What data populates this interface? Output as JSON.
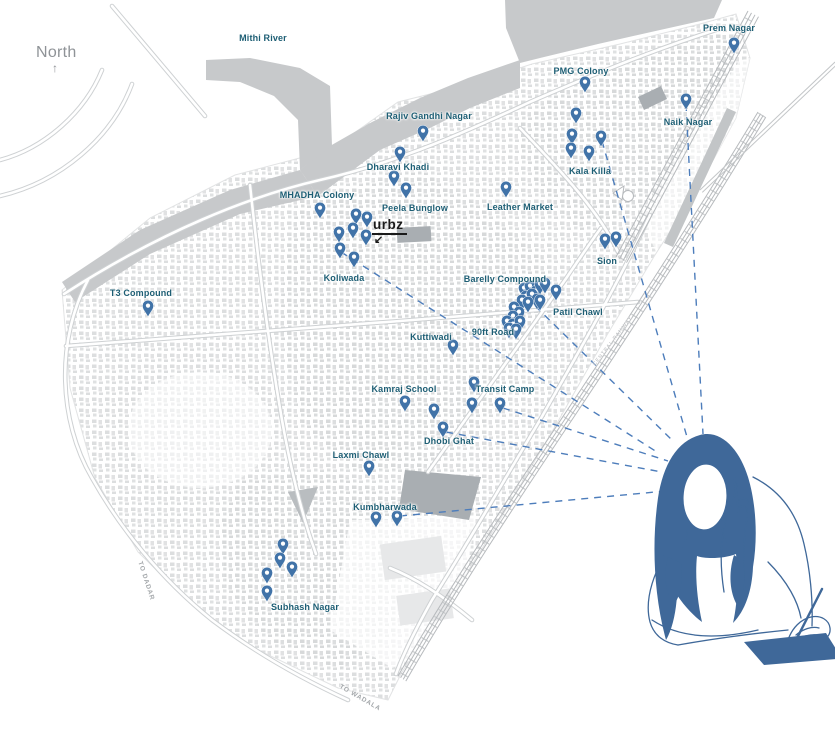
{
  "colors": {
    "pin": "#4173a8",
    "place_label": "#1d5e74",
    "road_label": "#a3a7aa",
    "rail_label": "#b0b3b6",
    "dashed_link": "#4d7dbb",
    "water": "#c7c9cb",
    "person": "#3f6899",
    "logo": "#1a1a1a",
    "north": "#8f9397"
  },
  "compass": {
    "label": "North"
  },
  "logo": {
    "text": "urbz",
    "arrow": "↙"
  },
  "map_labels": [
    {
      "id": "mithi-river",
      "text": "Mithi River",
      "x": 263,
      "y": 38,
      "type": "water"
    },
    {
      "id": "prem-nagar",
      "text": "Prem Nagar",
      "x": 729,
      "y": 28
    },
    {
      "id": "pmg-colony",
      "text": "PMG Colony",
      "x": 581,
      "y": 71
    },
    {
      "id": "naik-nagar",
      "text": "Naik Nagar",
      "x": 688,
      "y": 122
    },
    {
      "id": "kala-killa",
      "text": "Kala Killa",
      "x": 590,
      "y": 171
    },
    {
      "id": "rajiv-gandhi-nagar",
      "text": "Rajiv Gandhi Nagar",
      "x": 429,
      "y": 116
    },
    {
      "id": "dharavi-khadi",
      "text": "Dharavi Khadi",
      "x": 398,
      "y": 167
    },
    {
      "id": "mhadha-colony",
      "text": "MHADHA Colony",
      "x": 317,
      "y": 195
    },
    {
      "id": "peela-bunglow",
      "text": "Peela Bunglow",
      "x": 415,
      "y": 208
    },
    {
      "id": "leather-market",
      "text": "Leather Market",
      "x": 520,
      "y": 207
    },
    {
      "id": "koliwada",
      "text": "Koliwada",
      "x": 344,
      "y": 278
    },
    {
      "id": "barelly-compound",
      "text": "Barelly Compound",
      "x": 505,
      "y": 279
    },
    {
      "id": "patil-chawl",
      "text": "Patil Chawl",
      "x": 578,
      "y": 312
    },
    {
      "id": "sion",
      "text": "Sion",
      "x": 607,
      "y": 261
    },
    {
      "id": "t3-compound",
      "text": "T3 Compound",
      "x": 141,
      "y": 293
    },
    {
      "id": "90ft-road",
      "text": "90ft Road",
      "x": 493,
      "y": 332
    },
    {
      "id": "kuttiwadi",
      "text": "Kuttiwadi",
      "x": 431,
      "y": 337
    },
    {
      "id": "kamraj-school",
      "text": "Kamraj School",
      "x": 404,
      "y": 389
    },
    {
      "id": "transit-camp",
      "text": "Transit Camp",
      "x": 505,
      "y": 389
    },
    {
      "id": "dhobi-ghat",
      "text": "Dhobi Ghat",
      "x": 449,
      "y": 441
    },
    {
      "id": "laxmi-chawl",
      "text": "Laxmi Chawl",
      "x": 361,
      "y": 455
    },
    {
      "id": "kumbharwada",
      "text": "Kumbharwada",
      "x": 385,
      "y": 507
    },
    {
      "id": "subhash-nagar",
      "text": "Subhash Nagar",
      "x": 305,
      "y": 607
    },
    {
      "id": "to-dadar",
      "text": "TO DADAR",
      "x": 146,
      "y": 581,
      "type": "road",
      "rot": 72
    },
    {
      "id": "to-wadala",
      "text": "TO WADALA",
      "x": 360,
      "y": 698,
      "type": "road",
      "rot": 30
    },
    {
      "id": "central-railway",
      "text": "CENTRAL RAILWAY",
      "x": 613,
      "y": 341,
      "type": "rail",
      "rot": -52
    }
  ],
  "pins": [
    [
      734,
      44,
      "prem-nagar"
    ],
    [
      585,
      83,
      "pmg-colony"
    ],
    [
      686,
      100,
      "naik-nagar"
    ],
    [
      576,
      114
    ],
    [
      572,
      135
    ],
    [
      601,
      137
    ],
    [
      571,
      149
    ],
    [
      589,
      152
    ],
    [
      423,
      132,
      "rajiv-gandhi-nagar"
    ],
    [
      400,
      153
    ],
    [
      394,
      177,
      "dharavi-khadi"
    ],
    [
      406,
      189,
      "peela-bunglow"
    ],
    [
      320,
      209,
      "mhadha-colony"
    ],
    [
      506,
      188,
      "leather-market"
    ],
    [
      356,
      215
    ],
    [
      367,
      218
    ],
    [
      353,
      229
    ],
    [
      339,
      233
    ],
    [
      366,
      236
    ],
    [
      340,
      249
    ],
    [
      354,
      258
    ],
    [
      605,
      240,
      "sion"
    ],
    [
      616,
      238
    ],
    [
      148,
      307,
      "t3-compound"
    ],
    [
      524,
      289
    ],
    [
      530,
      287
    ],
    [
      536,
      292
    ],
    [
      540,
      285
    ],
    [
      545,
      284
    ],
    [
      556,
      291,
      "patil-chawl"
    ],
    [
      526,
      297
    ],
    [
      532,
      295
    ],
    [
      537,
      300
    ],
    [
      522,
      301
    ],
    [
      528,
      303
    ],
    [
      540,
      301
    ],
    [
      514,
      308
    ],
    [
      519,
      313
    ],
    [
      513,
      317
    ],
    [
      507,
      322
    ],
    [
      513,
      325
    ],
    [
      520,
      322
    ],
    [
      509,
      329
    ],
    [
      516,
      330
    ],
    [
      453,
      346,
      "kuttiwadi"
    ],
    [
      405,
      402,
      "kamraj-school"
    ],
    [
      474,
      383
    ],
    [
      472,
      404
    ],
    [
      500,
      404,
      "transit-camp"
    ],
    [
      434,
      410
    ],
    [
      443,
      428,
      "dhobi-ghat"
    ],
    [
      369,
      467,
      "laxmi-chawl"
    ],
    [
      376,
      518
    ],
    [
      397,
      517,
      "kumbharwada"
    ],
    [
      283,
      545
    ],
    [
      280,
      559
    ],
    [
      292,
      568
    ],
    [
      267,
      574
    ],
    [
      267,
      592
    ]
  ],
  "connections": [
    [
      686,
      104,
      703,
      434,
      "naik-nagar"
    ],
    [
      602,
      141,
      687,
      437,
      "kala-killa"
    ],
    [
      526,
      297,
      673,
      441,
      "barelly-compound"
    ],
    [
      341,
      252,
      657,
      452,
      "koliwada"
    ],
    [
      503,
      408,
      668,
      461,
      "transit-camp"
    ],
    [
      446,
      432,
      662,
      472,
      "dhobi-ghat"
    ],
    [
      400,
      516,
      666,
      491,
      "kumbharwada"
    ]
  ]
}
